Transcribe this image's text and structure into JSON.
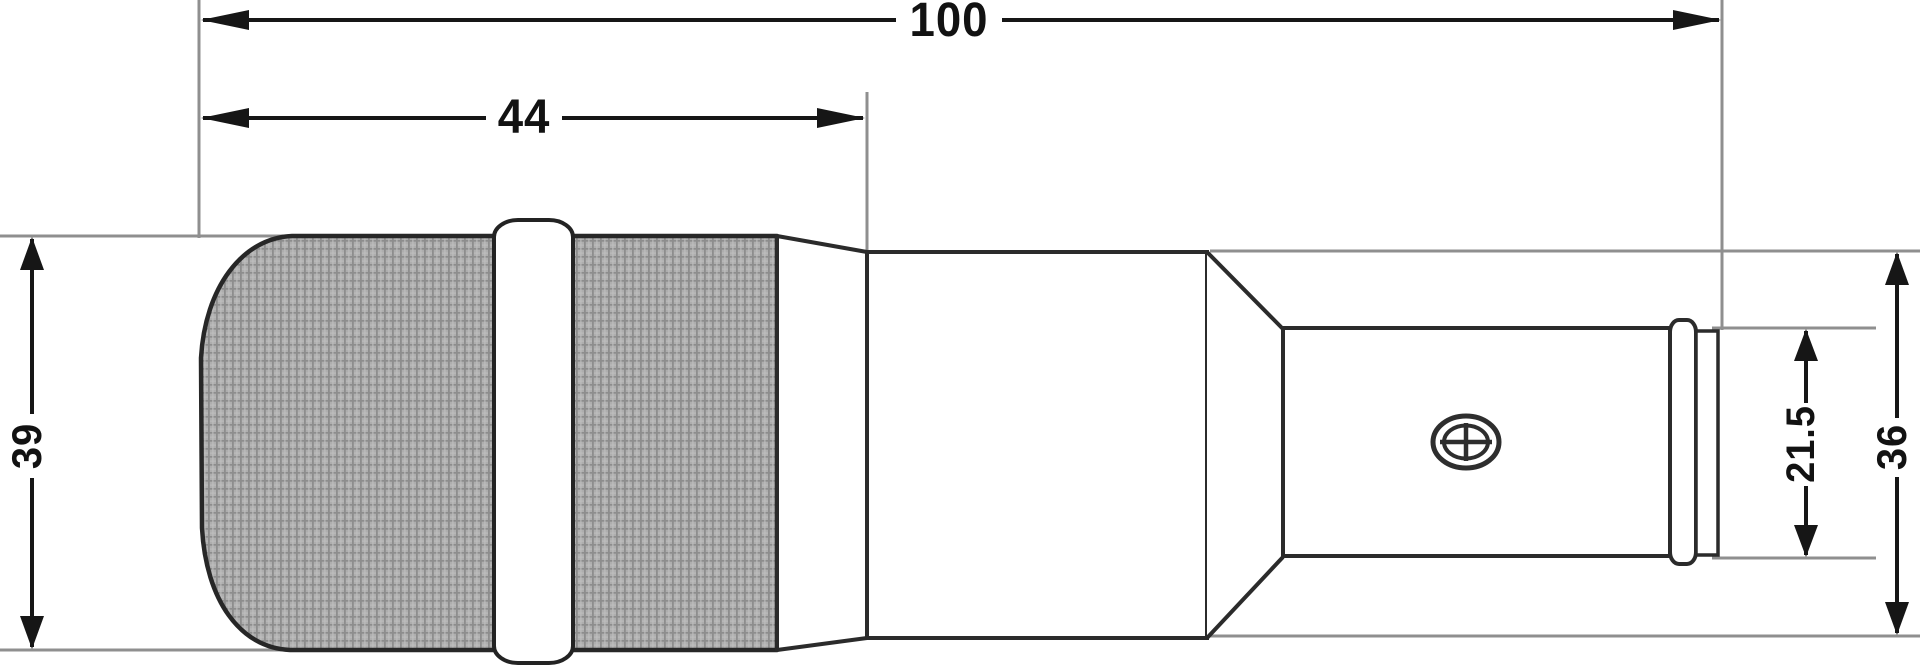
{
  "diagram": {
    "type": "technical-dimension-drawing",
    "subject": "microphone-side-profile",
    "dimensions": {
      "total_length": {
        "value": "100",
        "orientation": "horizontal"
      },
      "front_length": {
        "value": "44",
        "orientation": "horizontal"
      },
      "front_diameter": {
        "value": "39",
        "orientation": "vertical"
      },
      "connector_diameter": {
        "value": "21.5",
        "orientation": "vertical"
      },
      "body_diameter": {
        "value": "36",
        "orientation": "vertical"
      }
    },
    "icons": {
      "screw": "screw-head-icon"
    },
    "colors": {
      "background": "#ffffff",
      "outline": "#2b2b2b",
      "dimension_line": "#161616",
      "extension_line": "#8f8f8f",
      "grille_fill": "#aeaeae",
      "grille_grid": "#8d8d8d"
    }
  }
}
